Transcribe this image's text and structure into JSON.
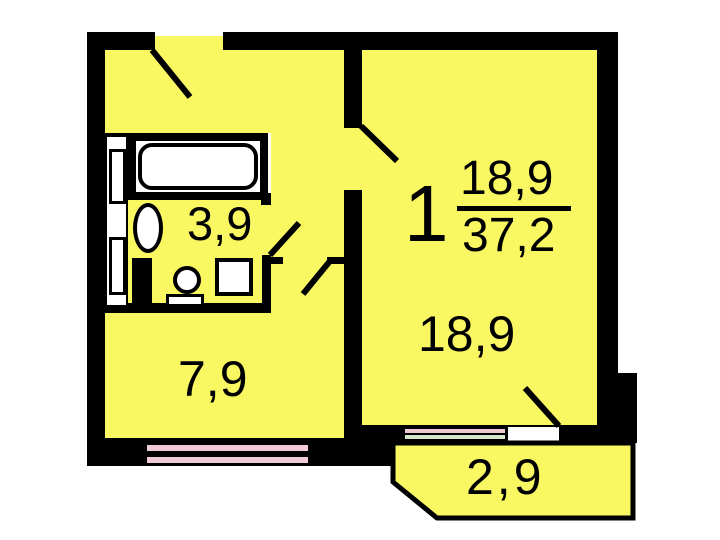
{
  "title": "1-room apartment floor plan",
  "labels": {
    "apartment_number": "1",
    "living_area": "18,9",
    "total_area": "37,2",
    "room_area": "18,9",
    "kitchen_area": "7,9",
    "bathroom_area": "3,9",
    "balcony_area": "2,9"
  },
  "colors": {
    "wall": "#000000",
    "room-fill": "#F9F862",
    "fixture-fill": "#FFFFFF",
    "stripe-pink": "#F0CAD5",
    "stripe-green": "#D8E7C9",
    "label-text": "#000000"
  }
}
